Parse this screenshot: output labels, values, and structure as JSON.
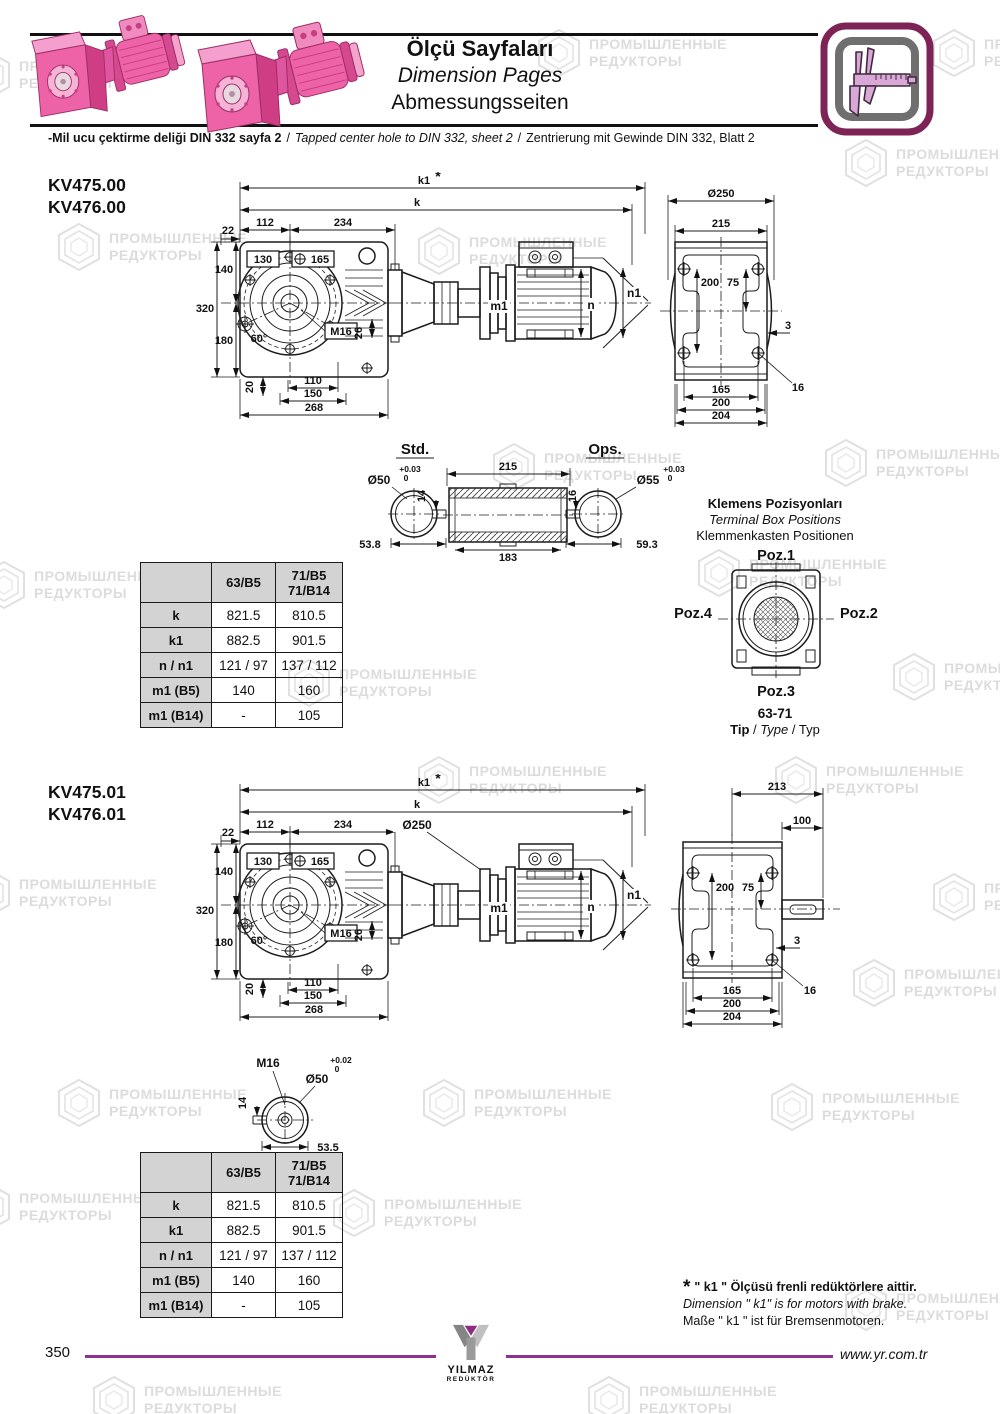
{
  "sep": "/",
  "watermark": {
    "line1": "ПРОМЫШЛЕННЫЕ",
    "line2": "РЕДУКТОРЫ"
  },
  "header": {
    "title_tr": "Ölçü Sayfaları",
    "title_en": "Dimension Pages",
    "title_de": "Abmessungsseiten",
    "sub_tr": "-Mil ucu çektirme deliği DIN 332 sayfa 2",
    "sub_en": "Tapped center hole to DIN 332, sheet 2",
    "sub_de": "Zentrierung mit Gewinde DIN 332, Blatt 2"
  },
  "sections": {
    "s1": {
      "model1": "KV475.00",
      "model2": "KV476.00"
    },
    "s2": {
      "model1": "KV475.01",
      "model2": "KV476.01"
    }
  },
  "front": {
    "k1": "k1",
    "star": "*",
    "k": "k",
    "w112": "112",
    "w234": "234",
    "w22": "22",
    "b130": "130",
    "b165": "165",
    "h140": "140",
    "h320": "320",
    "h180": "180",
    "a60": "60°",
    "m16": "M16",
    "v26": "26",
    "v20": "20",
    "b110": "110",
    "b150": "150",
    "b268": "268",
    "m1": "m1",
    "n": "n",
    "n1": "n1"
  },
  "front2": {
    "dia250": "Ø250"
  },
  "side1": {
    "dia250": "Ø250",
    "w215": "215",
    "v200": "200",
    "v75": "75",
    "t3": "3",
    "h16": "16",
    "b165": "165",
    "b200": "200",
    "b204": "204"
  },
  "side2": {
    "w213": "213",
    "w100": "100",
    "v200": "200",
    "v75": "75",
    "t3": "3",
    "h16": "16",
    "b165": "165",
    "b200": "200",
    "b204": "204"
  },
  "shafts": {
    "std_label": "Std.",
    "ops_label": "Ops.",
    "std": {
      "dia": "Ø50",
      "tol_hi": "+0.03",
      "tol_lo": "0",
      "key": "14",
      "width": "53.8"
    },
    "hollow": {
      "top": "215",
      "bottom": "183"
    },
    "ops": {
      "dia": "Ø55",
      "tol_hi": "+0.03",
      "tol_lo": "0",
      "key": "16",
      "width": "59.3"
    },
    "brake": {
      "m16": "M16",
      "dia": "Ø50",
      "tol_hi": "+0.02",
      "tol_lo": "0",
      "key": "14",
      "width": "53.5"
    }
  },
  "terminal": {
    "title_tr": "Klemens Pozisyonları",
    "title_en": "Terminal Box Positions",
    "title_de": "Klemmenkasten Positionen",
    "poz1": "Poz.1",
    "poz2": "Poz.2",
    "poz3": "Poz.3",
    "poz4": "Poz.4",
    "range": "63-71",
    "tip_tr": "Tip",
    "tip_en": "Type",
    "tip_de": "Typ"
  },
  "dim_table": {
    "col2_line1": "71/B5",
    "col2_line2": "71/B14",
    "col1": "63/B5",
    "rows": [
      {
        "label": "k",
        "v1": "821.5",
        "v2": "810.5"
      },
      {
        "label": "k1",
        "v1": "882.5",
        "v2": "901.5"
      },
      {
        "label": "n / n1",
        "v1": "121 / 97",
        "v2": "137 / 112"
      },
      {
        "label": "m1 (B5)",
        "v1": "140",
        "v2": "160"
      },
      {
        "label": "m1 (B14)",
        "v1": "-",
        "v2": "105"
      }
    ]
  },
  "footnote": {
    "star": "*",
    "tr": "\" k1 \" Ölçüsü frenli redüktörlere aittir.",
    "en": "Dimension \" k1\" is for motors with brake.",
    "de": "Maße \" k1 \" ist für Bremsenmotoren."
  },
  "footer": {
    "page": "350",
    "logo_top": "YILMAZ",
    "logo_bottom": "REDÜKTÖR",
    "url": "www.yr.com.tr"
  }
}
